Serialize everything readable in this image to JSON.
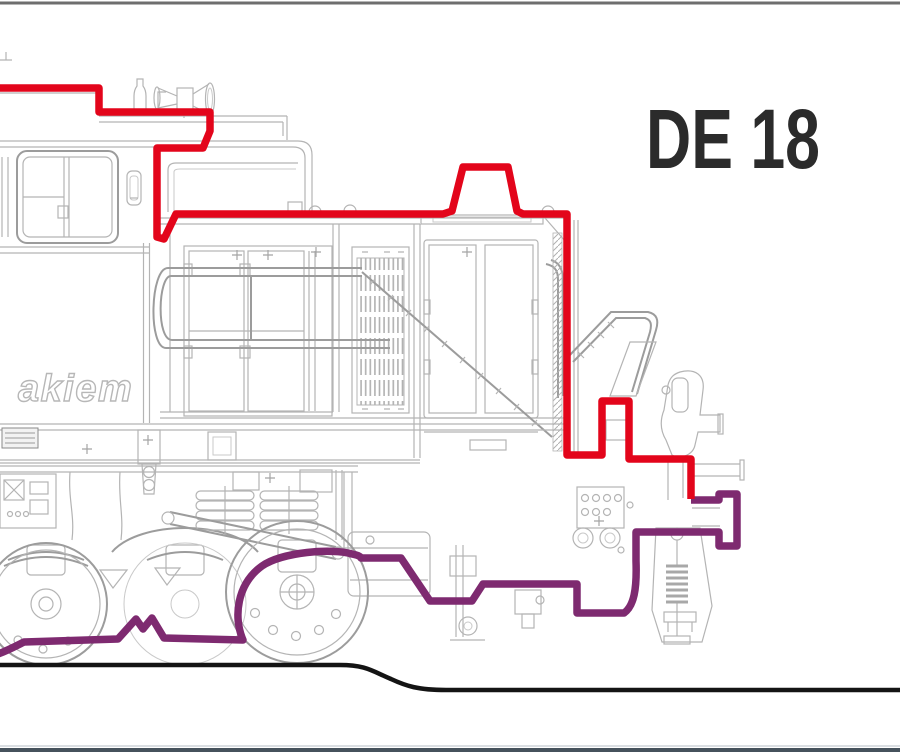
{
  "title": {
    "label": "DE 18"
  },
  "logo": {
    "label": "akiem"
  },
  "drawing": {
    "type": "locomotive-side-view-line-drawing"
  },
  "colors": {
    "background": "#ffffff",
    "outline_red": "#e3051b",
    "outline_purple": "#7e2a70",
    "ground_black": "#141414",
    "drawing_gray": "#b4b4b4",
    "title_black": "#2b2b2b",
    "top_border": "#6e6e6e",
    "bottom_border": "#46525c"
  }
}
